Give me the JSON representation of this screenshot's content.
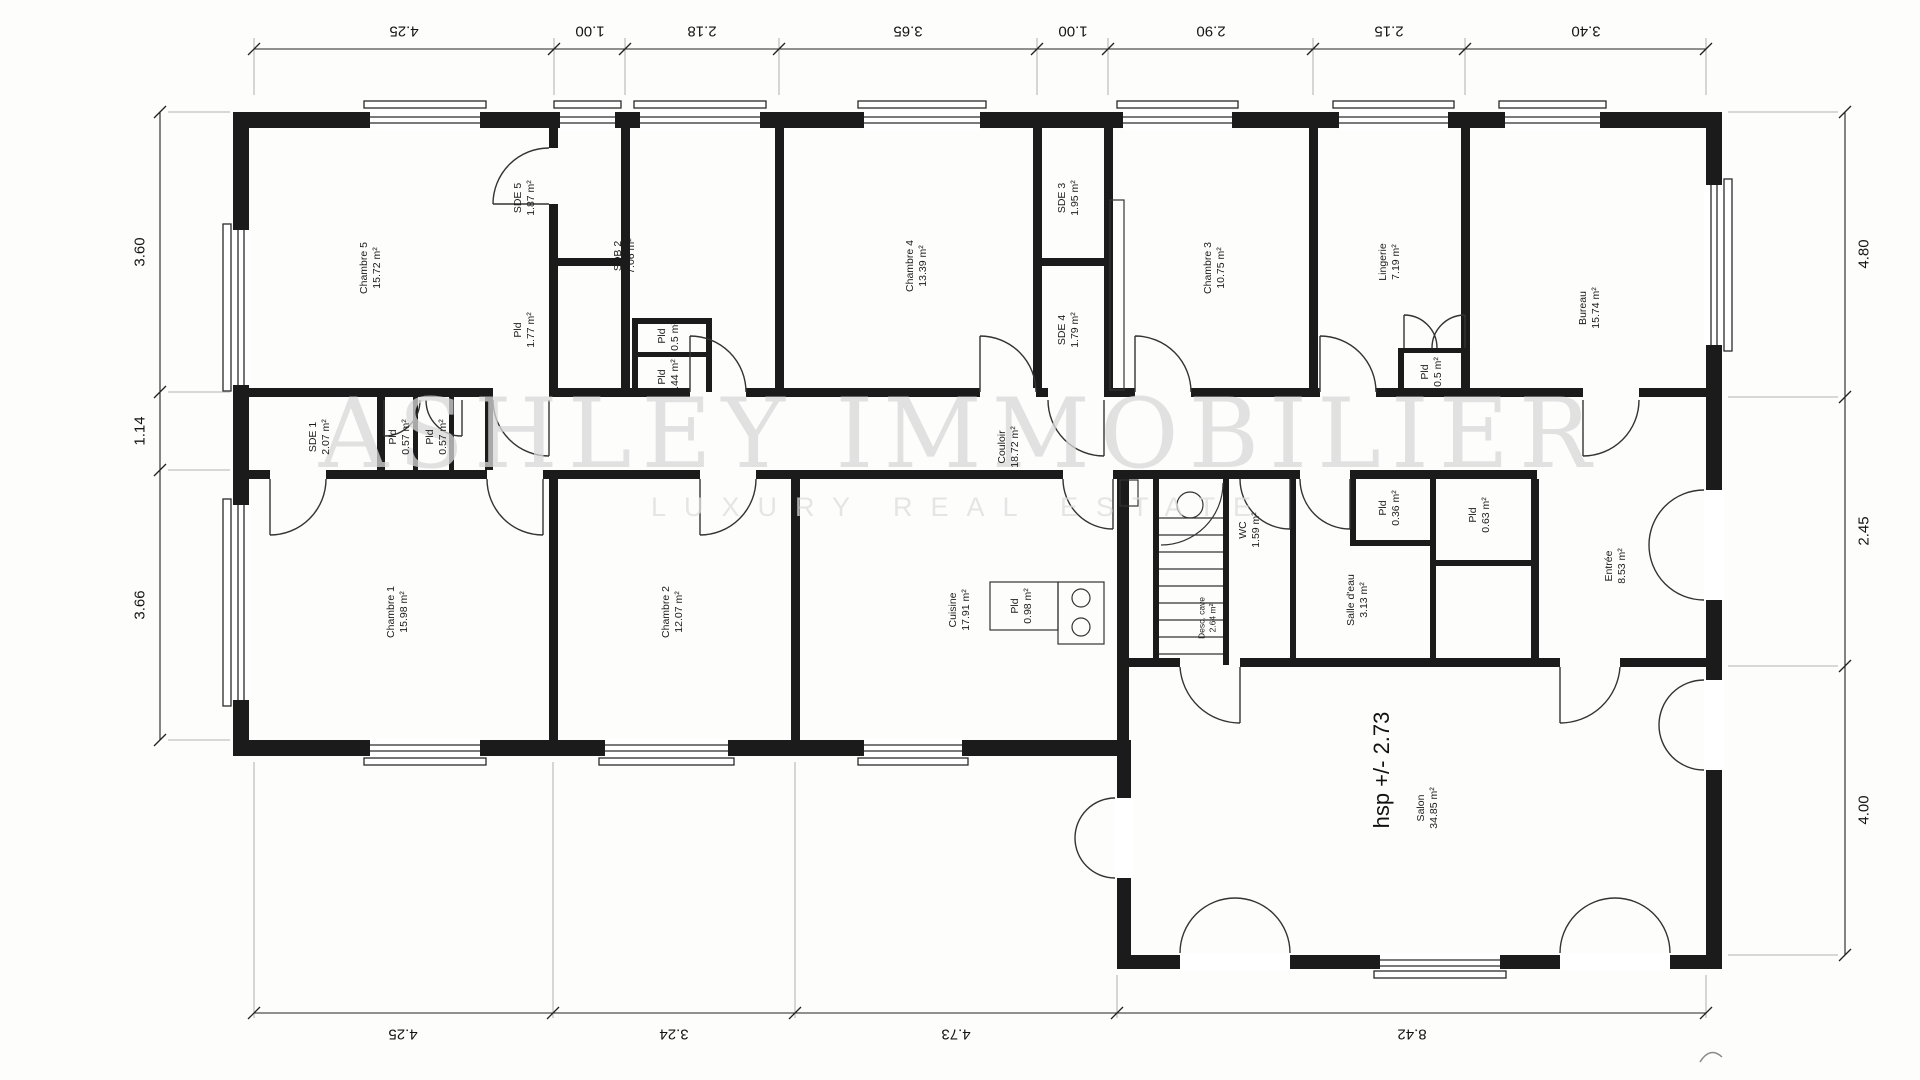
{
  "watermark": {
    "line1": "ASHLEY IMMOBILIER",
    "line2": "LUXURY REAL ESTATE"
  },
  "rooms": [
    {
      "name": "Chambre 5",
      "area": "15.72 m²"
    },
    {
      "name": "SDE 5",
      "area": "1.87 m²"
    },
    {
      "name": "Pld",
      "area": "1.77 m²"
    },
    {
      "name": "SDB 2",
      "area": "7.06 m²"
    },
    {
      "name": "Pld",
      "area": "0.5 m²"
    },
    {
      "name": "Pld",
      "area": "0.44 m²"
    },
    {
      "name": "Chambre 4",
      "area": "13.39 m²"
    },
    {
      "name": "SDE 3",
      "area": "1.95 m²"
    },
    {
      "name": "SDE 4",
      "area": "1.79 m²"
    },
    {
      "name": "Chambre 3",
      "area": "10.75 m²"
    },
    {
      "name": "Lingerie",
      "area": "7.19 m²"
    },
    {
      "name": "Pld",
      "area": "0.5 m²"
    },
    {
      "name": "Bureau",
      "area": "15.74 m²"
    },
    {
      "name": "SDE 1",
      "area": "2.07 m²"
    },
    {
      "name": "Pld",
      "area": "0.57 m²"
    },
    {
      "name": "Pld",
      "area": "0.57 m²"
    },
    {
      "name": "Couloir",
      "area": "18.72 m²"
    },
    {
      "name": "Chambre 1",
      "area": "15.98 m²"
    },
    {
      "name": "Chambre 2",
      "area": "12.07 m²"
    },
    {
      "name": "Pld",
      "area": "0.98 m²"
    },
    {
      "name": "Cuisine",
      "area": "17.91 m²"
    },
    {
      "name": "Desc. cave",
      "area": "2.64 m²"
    },
    {
      "name": "WC",
      "area": "1.59 m²"
    },
    {
      "name": "Pld",
      "area": "0.36 m²"
    },
    {
      "name": "Salle d'eau",
      "area": "3.13 m²"
    },
    {
      "name": "Pld",
      "area": "0.63 m²"
    },
    {
      "name": "Entrée",
      "area": "8.53 m²"
    },
    {
      "name": "Salon",
      "area": "34.85 m²",
      "note": "hsp +/- 2.73"
    }
  ],
  "dims": {
    "top": [
      "4.25",
      "1.00",
      "2.18",
      "3.65",
      "1.00",
      "2.90",
      "2.15",
      "3.40"
    ],
    "left": [
      "3.60",
      "1.14",
      "3.66"
    ],
    "right": [
      "4.80",
      "2.45",
      "4.00"
    ],
    "bottom": [
      "4.25",
      "3.24",
      "4.73",
      "8.42"
    ]
  },
  "colors": {
    "wall": "#1b1b1b",
    "line": "#333333",
    "dimline": "#222222",
    "watermark": "#d8d8d8",
    "paper": "#fdfdfc"
  }
}
